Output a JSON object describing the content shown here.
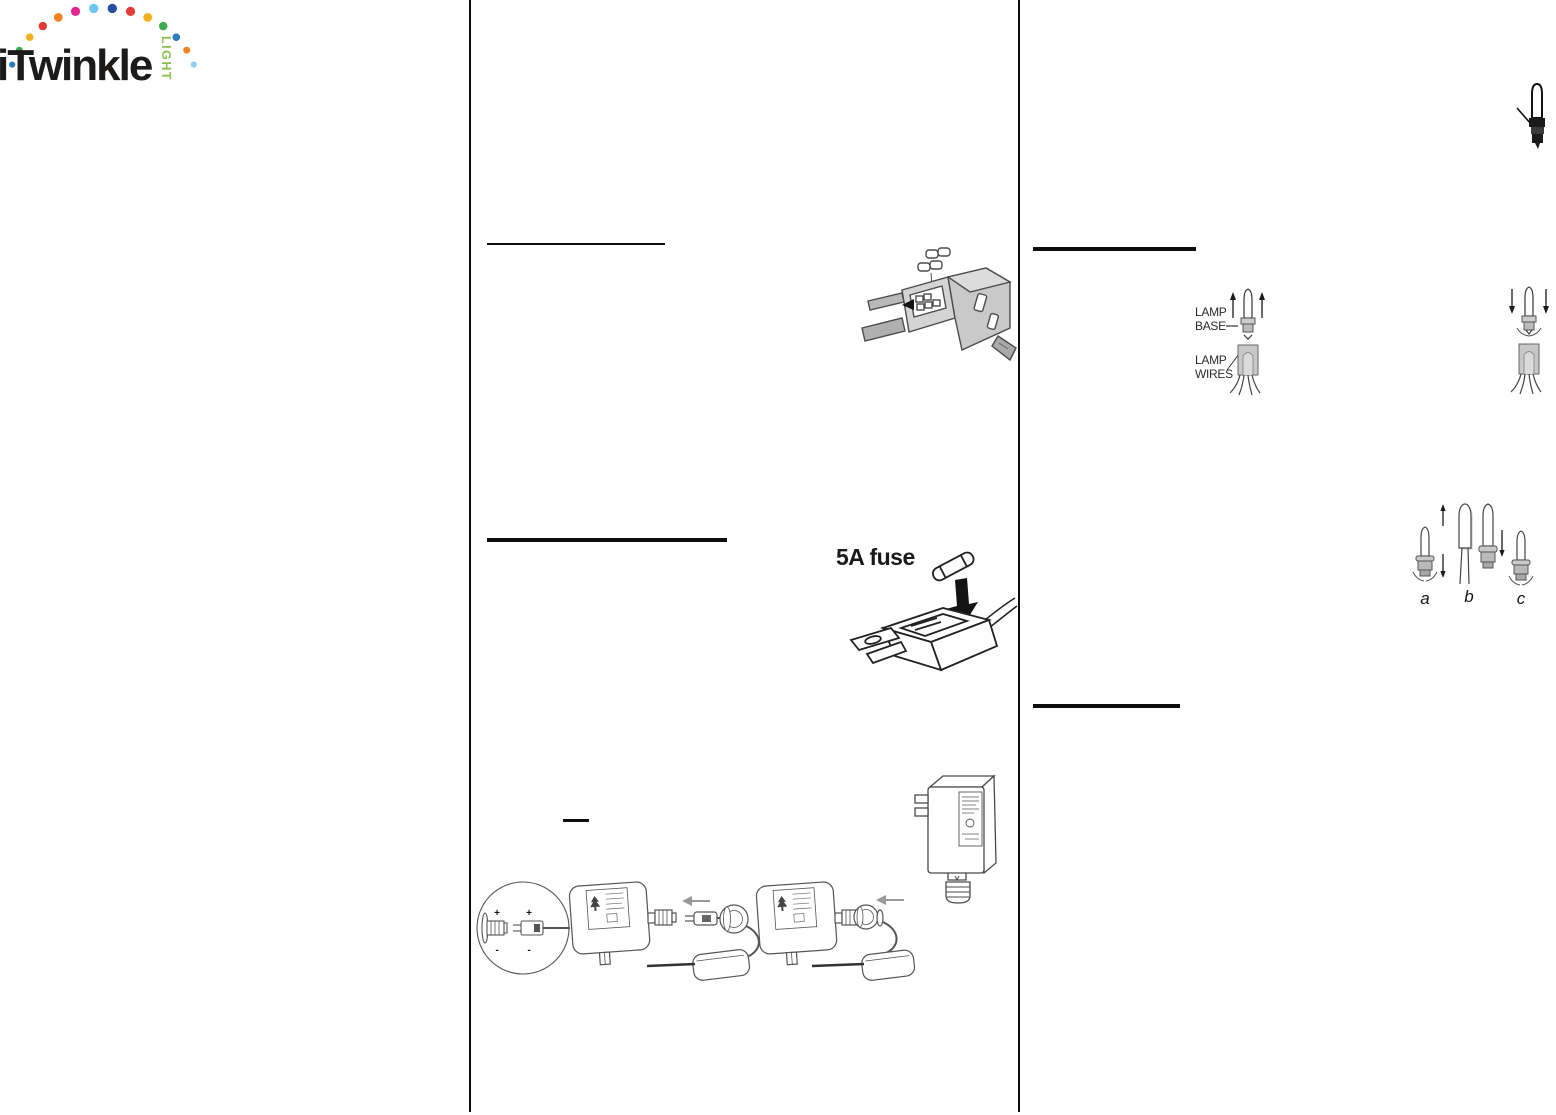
{
  "logo": {
    "brand": "iTwinkle",
    "sub": "LIGHT",
    "brand_color": "#1c1b1a",
    "sub_color": "#8cc152",
    "dot_colors": [
      "#2d7bc1",
      "#3faa49",
      "#f2b01e",
      "#e23a36",
      "#f58220",
      "#e3268e",
      "#6ec6ee",
      "#274fa1",
      "#e23a36",
      "#f2b01e",
      "#3faa49",
      "#2d7bc1",
      "#f58220",
      "#8fd0f0"
    ]
  },
  "middle_column": {
    "fuse_rating_label": "5A fuse"
  },
  "right_column": {
    "lamp_diagram": {
      "base_label_line1": "LAMP",
      "base_label_line2": "BASE",
      "wires_label_line1": "LAMP",
      "wires_label_line2": "WIRES"
    },
    "replacement_steps": {
      "step_a": "a",
      "step_b": "b",
      "step_c": "c"
    }
  },
  "polarity": {
    "plus": "+",
    "minus": "-"
  }
}
